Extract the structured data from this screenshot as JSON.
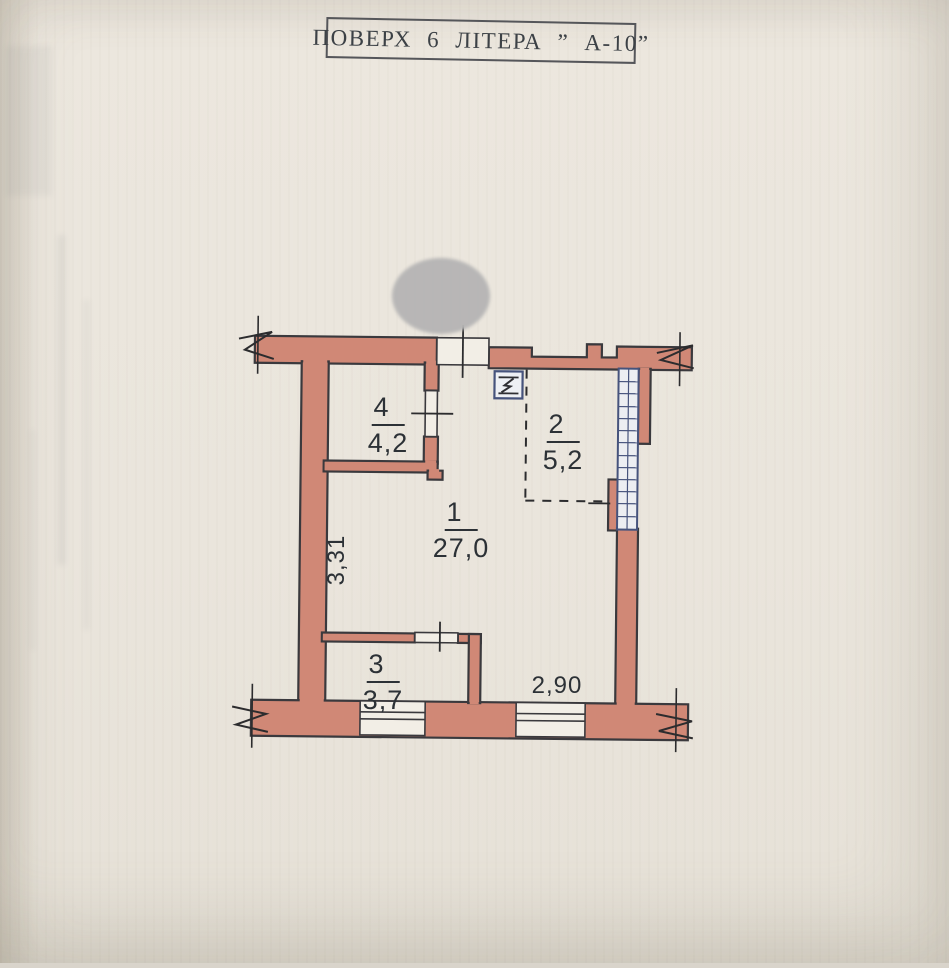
{
  "document": {
    "title": "ПОВЕРХ  6  ЛІТЕРА  ” А-10”"
  },
  "plan": {
    "rooms": [
      {
        "number": "1",
        "area": "27,0"
      },
      {
        "number": "2",
        "area": "5,2"
      },
      {
        "number": "3",
        "area": "3,7"
      },
      {
        "number": "4",
        "area": "4,2"
      }
    ],
    "dimensions": [
      {
        "label": "3,31",
        "orientation": "vertical"
      },
      {
        "label": "2,90",
        "orientation": "horizontal"
      }
    ],
    "symbols": [
      {
        "name": "electric-panel-icon"
      }
    ],
    "colors": {
      "wall_fill": "#d08876",
      "outline": "#3a393d",
      "window_blue": "#46537c",
      "paper": "#e9e4db",
      "redaction_gray": "#b6b5b5"
    }
  }
}
